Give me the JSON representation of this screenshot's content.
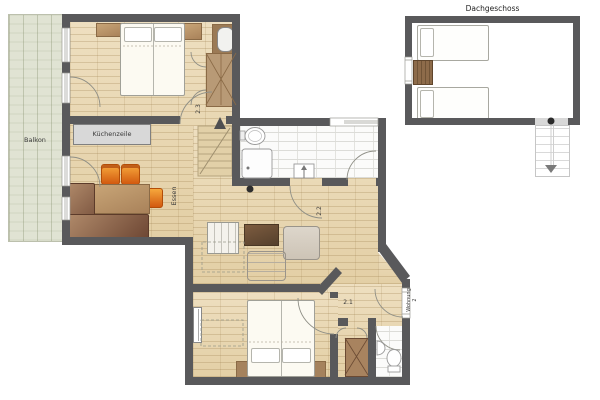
{
  "plan_title": "Dachgeschoss",
  "labels": {
    "balcony": "Balkon",
    "kitchen_unit": "Küchenzeile",
    "dining": "Essen",
    "room_2_3": "2.3",
    "room_2_2": "2.2",
    "room_2_1": "2.1",
    "apartment_line1": "Wohnung",
    "apartment_line2": "2",
    "attic": "Dachgeschoss"
  },
  "icons": {
    "stairs_up_arrow": "triangle pointing up at apartment staircase",
    "stairs_down_arrow": "triangle pointing down at attic staircase"
  },
  "colors": {
    "wall": "#59595b",
    "parquet": "#e9d8b2",
    "tile": "#fbfbfa",
    "balcony": "#e0e3d3",
    "label_box": "#d8d8d8",
    "furniture_brown": "#a97c5e",
    "chair_orange": "#e8731a",
    "attic_floor": "#ffffff"
  }
}
